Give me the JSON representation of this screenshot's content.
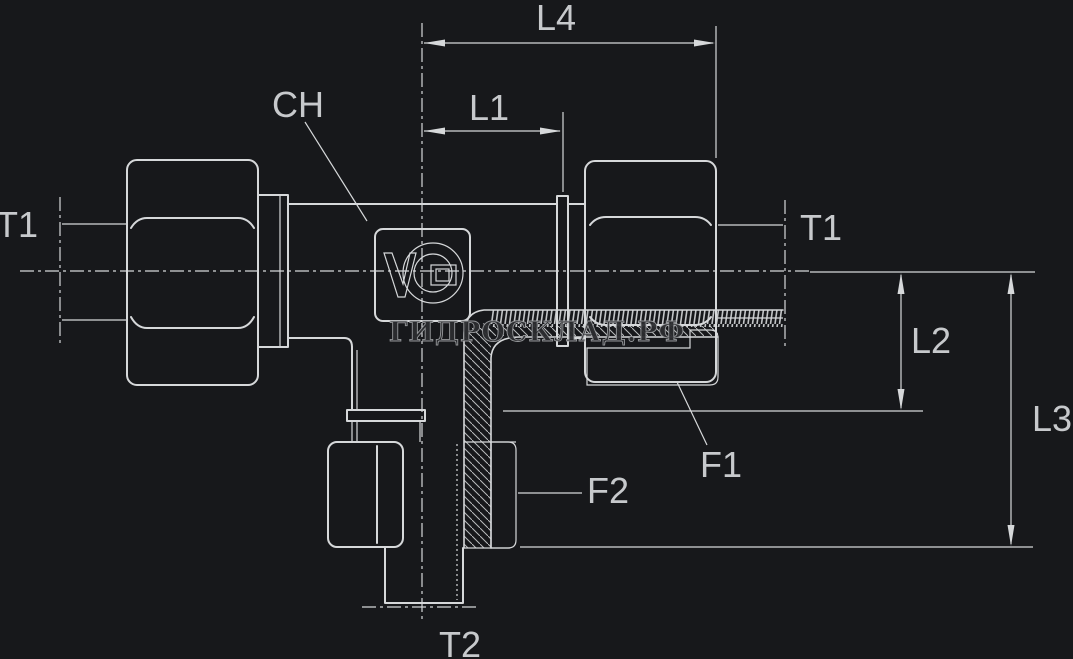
{
  "drawing": {
    "type": "technical-drawing-tee-fitting",
    "labels": {
      "l4": "L4",
      "l1": "L1",
      "l2": "L2",
      "l3": "L3",
      "ch": "CH",
      "t1_left": "T1",
      "t1_right": "T1",
      "f1": "F1",
      "f2": "F2",
      "t2": "T2"
    },
    "watermark": "ГИДРОСКЛАД.РФ",
    "icons": {
      "logo": "v-circle-brand-logo"
    },
    "colors": {
      "background": "#17181b",
      "line": "#d6d8da",
      "label": "#c7c9cc",
      "watermark_fill": "#2c2d30",
      "watermark_stroke": "#9b9da0"
    }
  }
}
